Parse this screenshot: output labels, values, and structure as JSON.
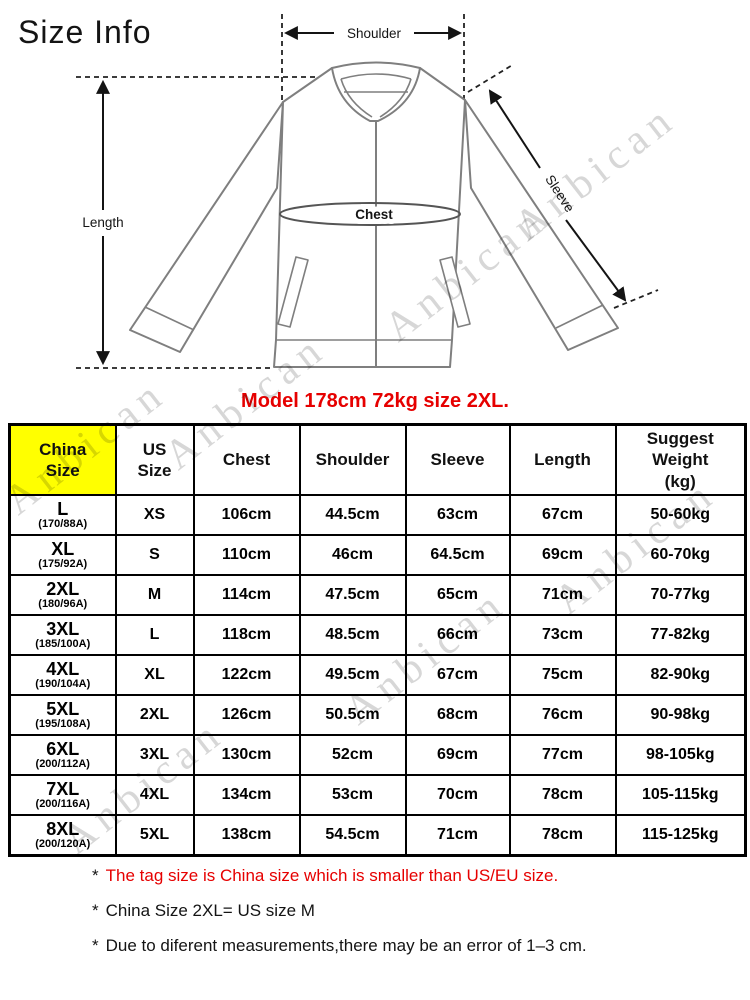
{
  "title": "Size Info",
  "watermark": {
    "text": "Anbican"
  },
  "diagram": {
    "labels": {
      "shoulder": "Shoulder",
      "length": "Length",
      "chest": "Chest",
      "sleeve": "Sleeve"
    },
    "caption": "Model 178cm 72kg size 2XL."
  },
  "table": {
    "headers": {
      "china": "China\nSize",
      "us": "US\nSize",
      "chest": "Chest",
      "shoulder": "Shoulder",
      "sleeve": "Sleeve",
      "length": "Length",
      "weight": "Suggest\nWeight\n(kg)"
    },
    "rows": [
      {
        "china": "L",
        "china_sub": "(170/88A)",
        "us": "XS",
        "chest": "106cm",
        "shoulder": "44.5cm",
        "sleeve": "63cm",
        "length": "67cm",
        "weight": "50-60kg"
      },
      {
        "china": "XL",
        "china_sub": "(175/92A)",
        "us": "S",
        "chest": "110cm",
        "shoulder": "46cm",
        "sleeve": "64.5cm",
        "length": "69cm",
        "weight": "60-70kg"
      },
      {
        "china": "2XL",
        "china_sub": "(180/96A)",
        "us": "M",
        "chest": "114cm",
        "shoulder": "47.5cm",
        "sleeve": "65cm",
        "length": "71cm",
        "weight": "70-77kg"
      },
      {
        "china": "3XL",
        "china_sub": "(185/100A)",
        "us": "L",
        "chest": "118cm",
        "shoulder": "48.5cm",
        "sleeve": "66cm",
        "length": "73cm",
        "weight": "77-82kg"
      },
      {
        "china": "4XL",
        "china_sub": "(190/104A)",
        "us": "XL",
        "chest": "122cm",
        "shoulder": "49.5cm",
        "sleeve": "67cm",
        "length": "75cm",
        "weight": "82-90kg"
      },
      {
        "china": "5XL",
        "china_sub": "(195/108A)",
        "us": "2XL",
        "chest": "126cm",
        "shoulder": "50.5cm",
        "sleeve": "68cm",
        "length": "76cm",
        "weight": "90-98kg"
      },
      {
        "china": "6XL",
        "china_sub": "(200/112A)",
        "us": "3XL",
        "chest": "130cm",
        "shoulder": "52cm",
        "sleeve": "69cm",
        "length": "77cm",
        "weight": "98-105kg"
      },
      {
        "china": "7XL",
        "china_sub": "(200/116A)",
        "us": "4XL",
        "chest": "134cm",
        "shoulder": "53cm",
        "sleeve": "70cm",
        "length": "78cm",
        "weight": "105-115kg"
      },
      {
        "china": "8XL",
        "china_sub": "(200/120A)",
        "us": "5XL",
        "chest": "138cm",
        "shoulder": "54.5cm",
        "sleeve": "71cm",
        "length": "78cm",
        "weight": "115-125kg"
      }
    ]
  },
  "footnotes": [
    {
      "marker": "*",
      "text": "The tag size is China size which is smaller than US/EU size."
    },
    {
      "marker": "*",
      "text": "China Size 2XL= US size M"
    },
    {
      "marker": "*",
      "text": "Due to diferent measurements,there may be an error of 1–3 cm."
    }
  ],
  "colors": {
    "accent_red": "#e60000",
    "header_yellow": "#ffff00",
    "diagram_gray": "#7f7f7f",
    "watermark_gray": "#d7d7d7"
  }
}
